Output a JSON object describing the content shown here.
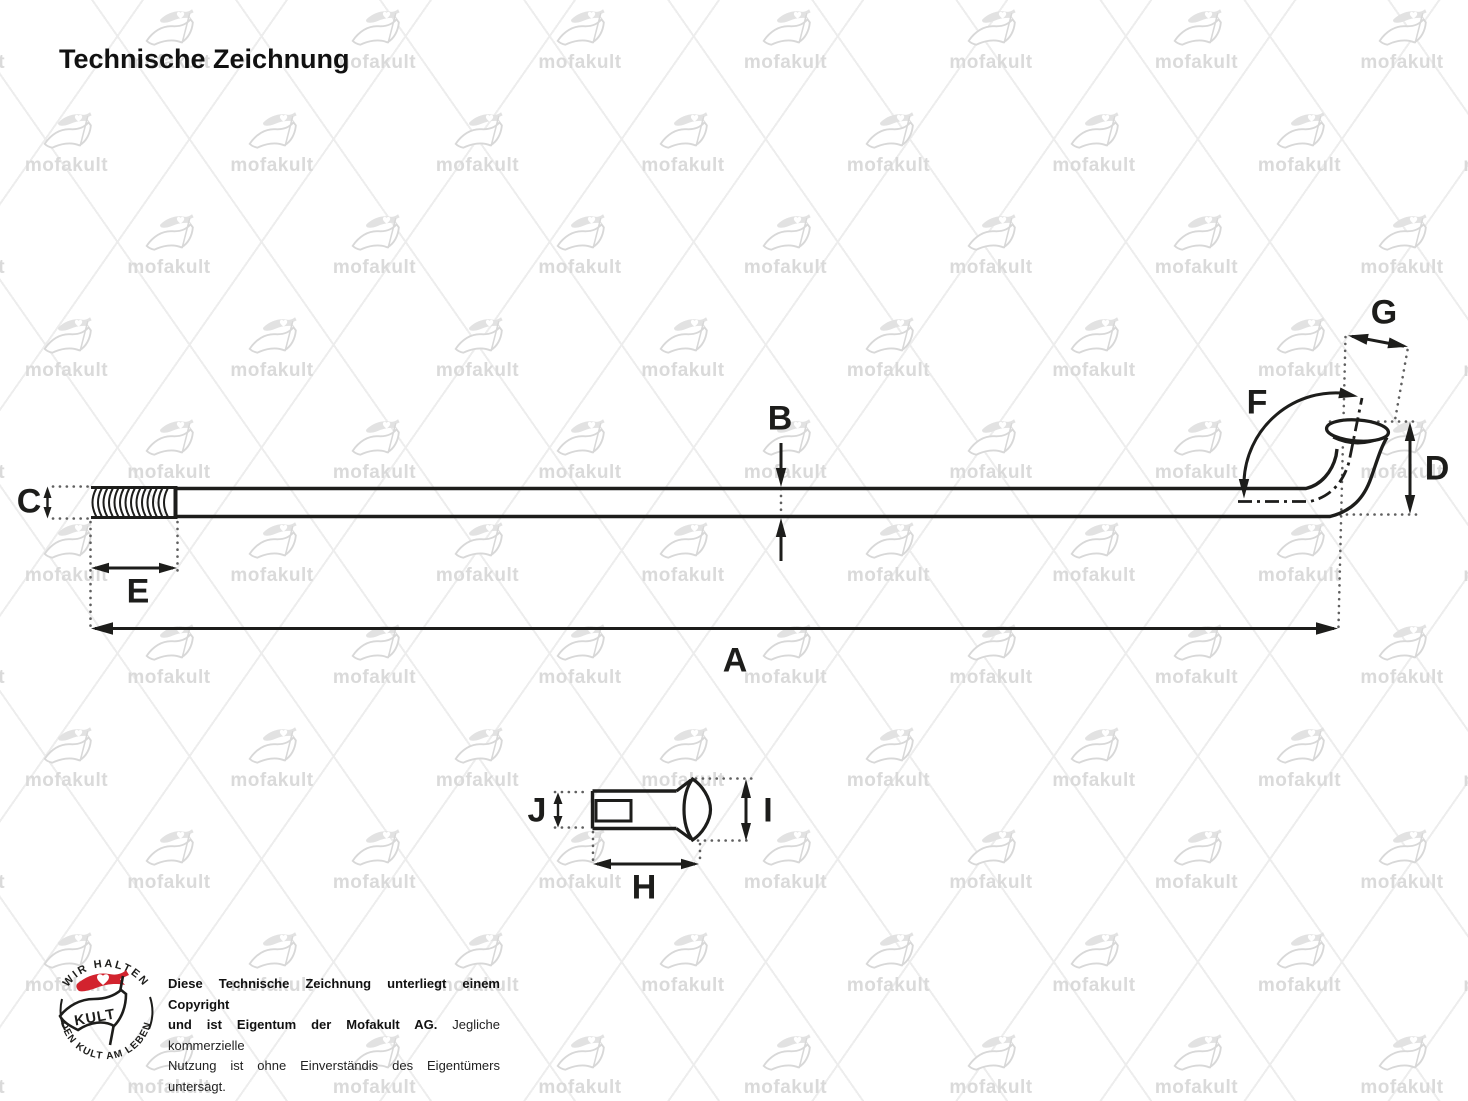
{
  "header": {
    "title": "Technische Zeichnung"
  },
  "watermark": {
    "text": "mofakult"
  },
  "drawing": {
    "labels": {
      "a": "A",
      "b": "B",
      "c": "C",
      "d": "D",
      "e": "E",
      "f": "F",
      "g": "G",
      "h": "H",
      "i": "I",
      "j": "J"
    }
  },
  "footer": {
    "badge": {
      "top_arc": "WIR HALTEN",
      "bottom_arc": "DEN KULT AM LEBEN",
      "flag": "KULT"
    },
    "copyright_lines": [
      {
        "bold": "Diese Technische Zeichnung unterliegt einem Copyright",
        "normal": ""
      },
      {
        "bold": "und ist Eigentum der Mofakult AG.",
        "normal": " Jegliche kommerzielle"
      },
      {
        "bold": "",
        "normal": "Nutzung ist ohne Einverständis des Eigentümers untersagt."
      },
      {
        "bold": "",
        "normal": "Verstösse werden rechtlich verfolgt."
      }
    ]
  },
  "colors": {
    "ink": "#1d1d1b",
    "guide": "#5f5f5f",
    "accent_red": "#d2232e",
    "watermark_gray": "#dadada"
  }
}
